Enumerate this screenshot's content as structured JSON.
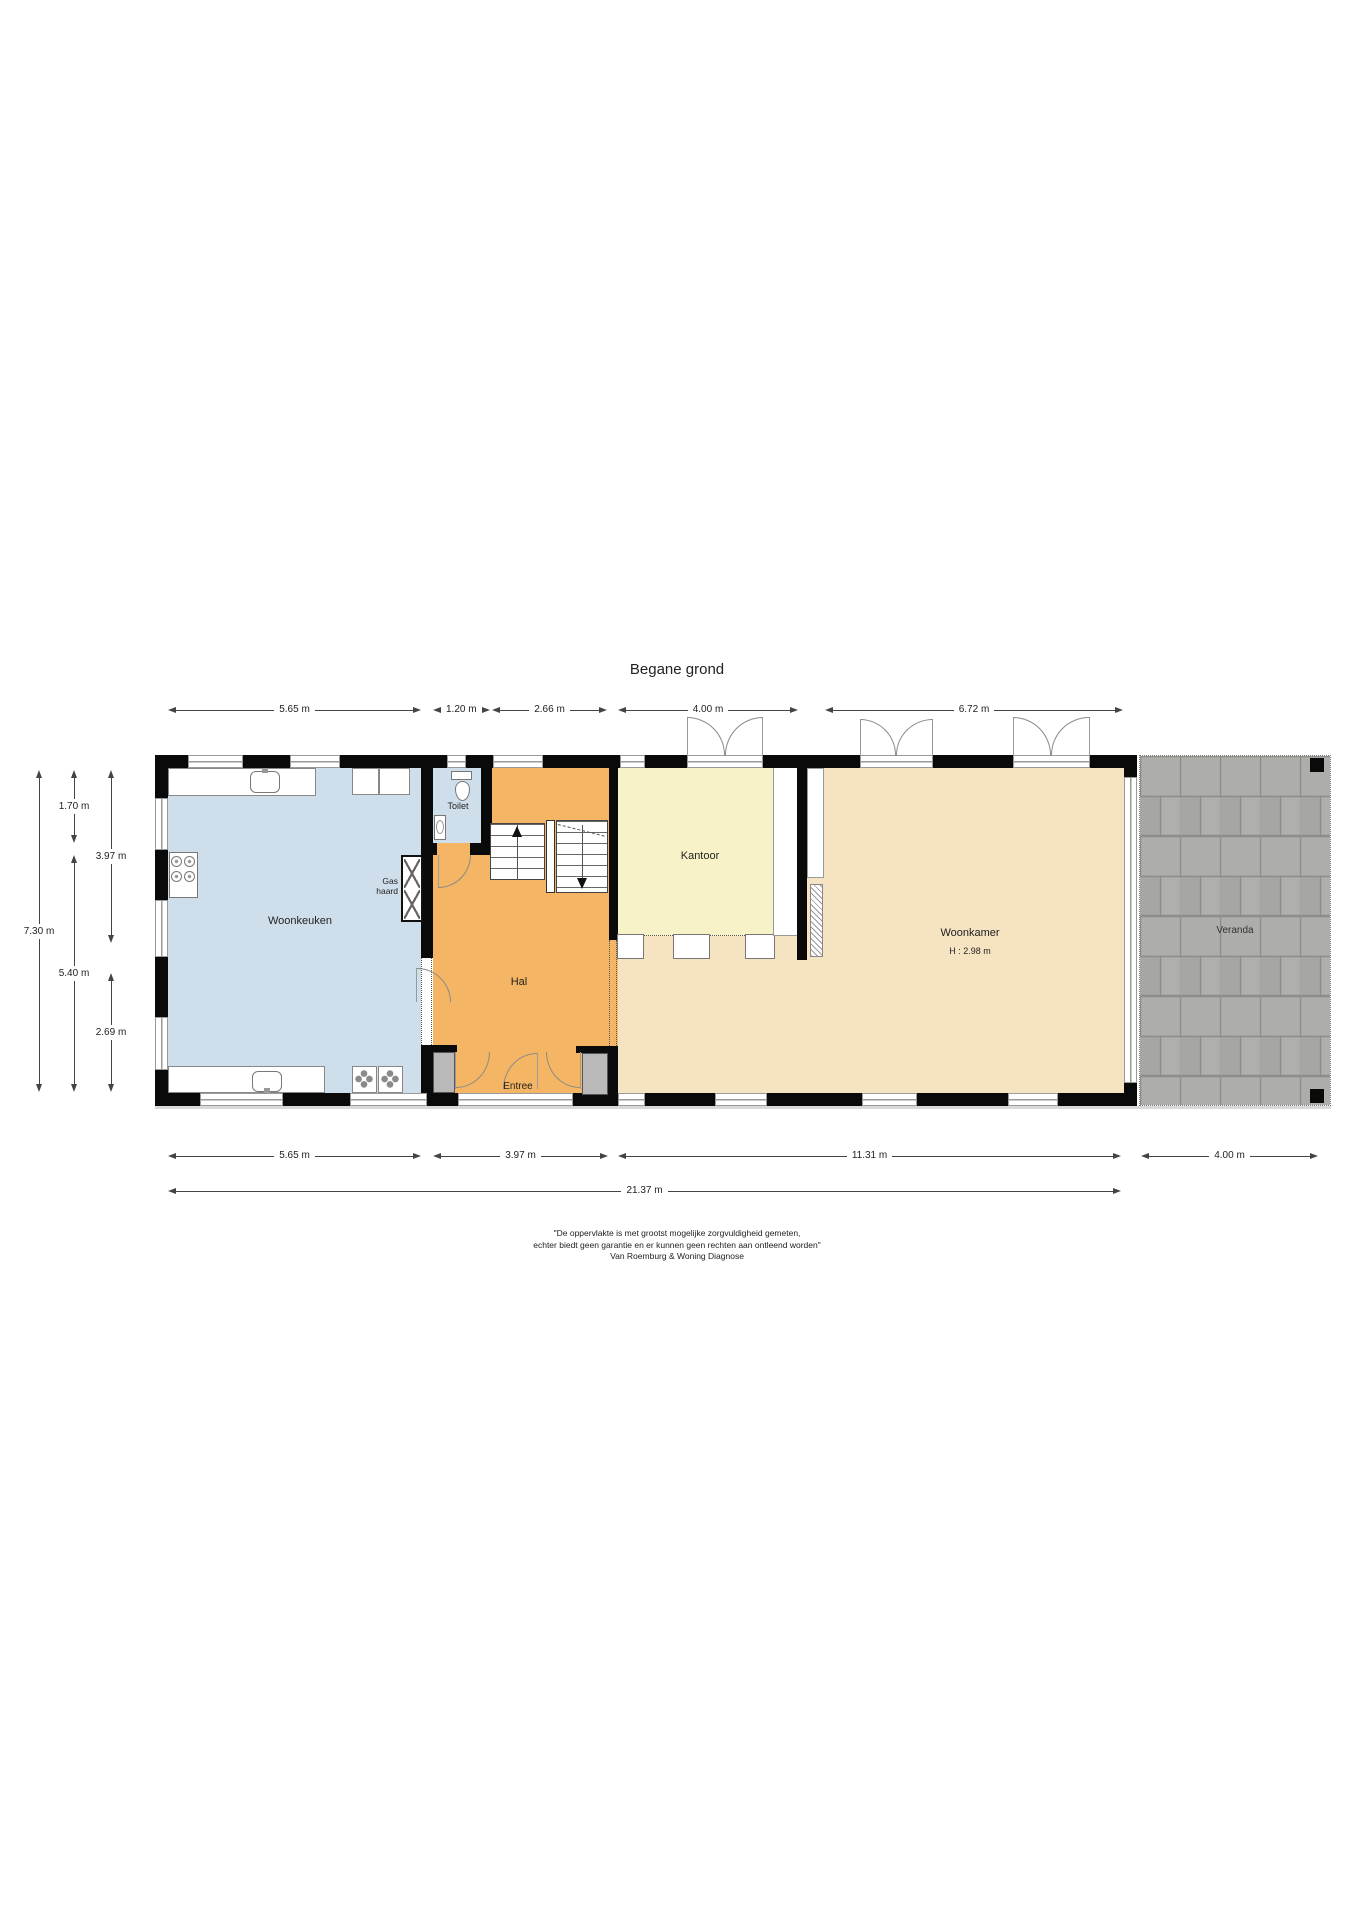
{
  "title": "Begane grond",
  "rooms": {
    "woonkeuken": "Woonkeuken",
    "toilet": "Toilet",
    "hal": "Hal",
    "entree": "Entree",
    "kantoor": "Kantoor",
    "woonkamer": "Woonkamer",
    "woonkamer_height": "H : 2.98 m",
    "veranda": "Veranda",
    "gas_haard": "Gas haard"
  },
  "dimensions": {
    "top": [
      "5.65 m",
      "1.20 m",
      "2.66 m",
      "4.00 m",
      "6.72 m"
    ],
    "left": [
      "7.30 m",
      "1.70 m",
      "5.40 m",
      "3.97 m",
      "2.69 m"
    ],
    "bottom": [
      "5.65 m",
      "3.97 m",
      "11.31 m",
      "4.00 m"
    ],
    "bottom_total": "21.37 m"
  },
  "colors": {
    "woonkeuken": "#cfdeeb",
    "toilet": "#cfdeeb",
    "hal": "#f4b564",
    "kantoor": "#f8f2c8",
    "woonkamer": "#f5e3c1"
  },
  "disclaimer": {
    "line1": "\"De oppervlakte is met grootst mogelijke zorgvuldigheid gemeten,",
    "line2": "echter biedt geen garantie en er kunnen geen rechten aan ontleend worden\"",
    "line3": "Van Roemburg & Woning Diagnose"
  }
}
